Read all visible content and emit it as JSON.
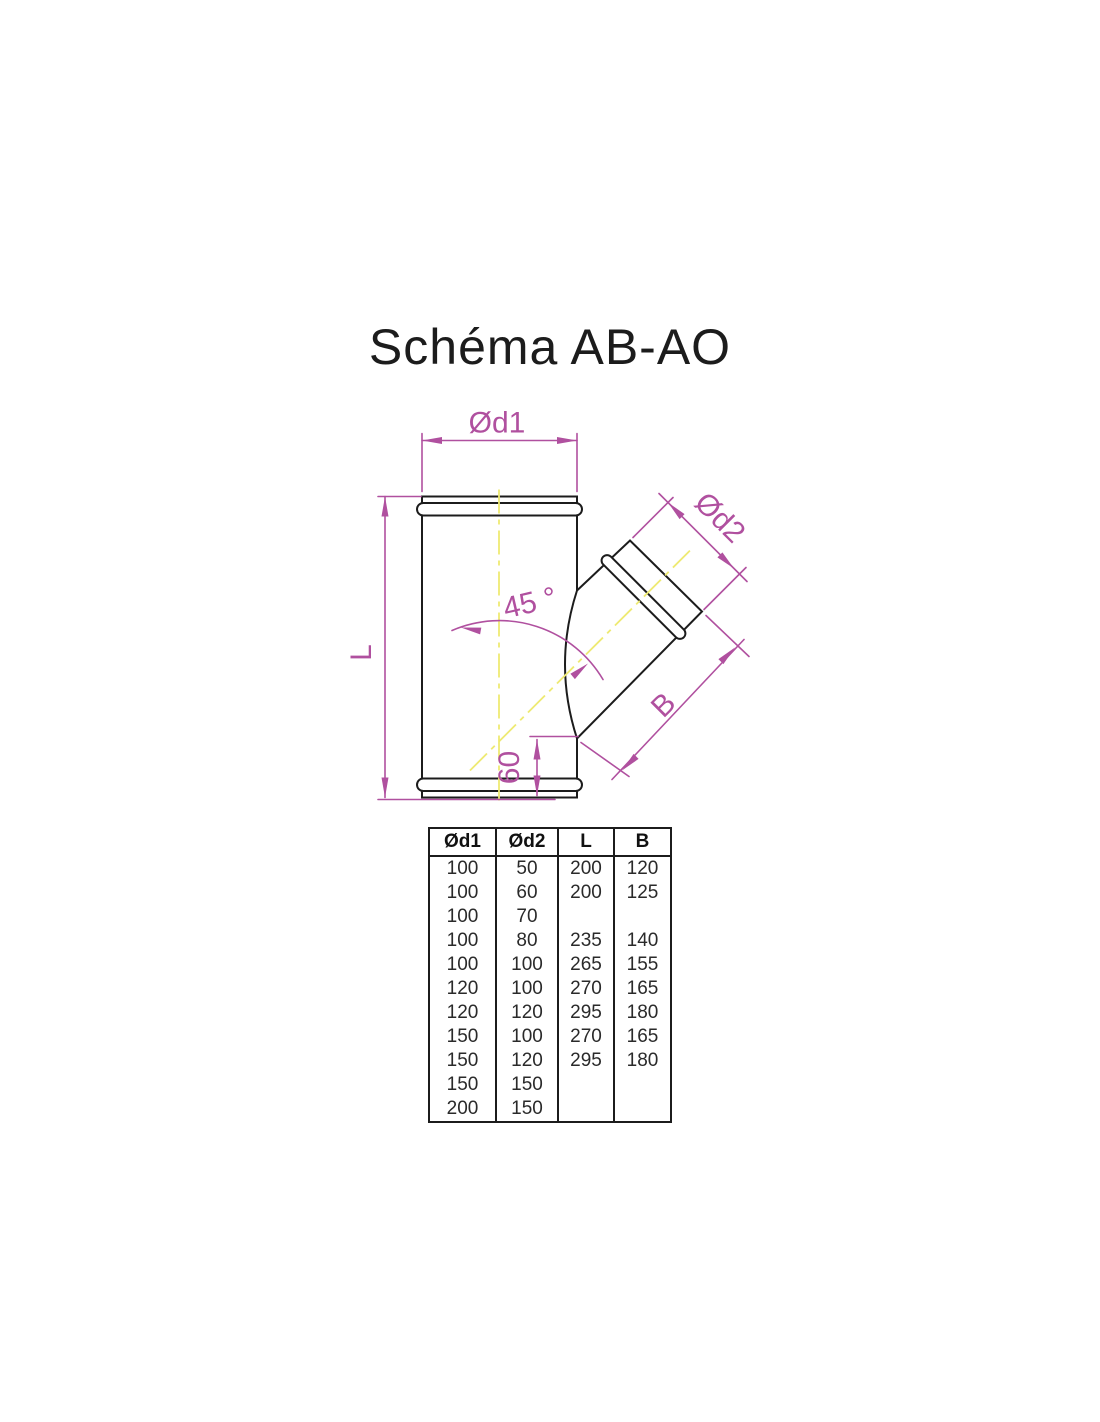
{
  "title": "Schéma AB-AO",
  "diagram": {
    "labels": {
      "d1": "Ød1",
      "d2": "Ød2",
      "length": "L",
      "branch_length": "B",
      "angle": "45 °",
      "offset": "60"
    },
    "colors": {
      "outline": "#1c1c1c",
      "dimension": "#b0509f",
      "centerline": "#eeea72"
    }
  },
  "table": {
    "headers": [
      "Ød1",
      "Ød2",
      "L",
      "B"
    ],
    "rows": [
      [
        "100",
        "50",
        "200",
        "120"
      ],
      [
        "100",
        "60",
        "200",
        "125"
      ],
      [
        "100",
        "70",
        "",
        ""
      ],
      [
        "100",
        "80",
        "235",
        "140"
      ],
      [
        "100",
        "100",
        "265",
        "155"
      ],
      [
        "120",
        "100",
        "270",
        "165"
      ],
      [
        "120",
        "120",
        "295",
        "180"
      ],
      [
        "150",
        "100",
        "270",
        "165"
      ],
      [
        "150",
        "120",
        "295",
        "180"
      ],
      [
        "150",
        "150",
        "",
        ""
      ],
      [
        "200",
        "150",
        "",
        ""
      ]
    ]
  }
}
